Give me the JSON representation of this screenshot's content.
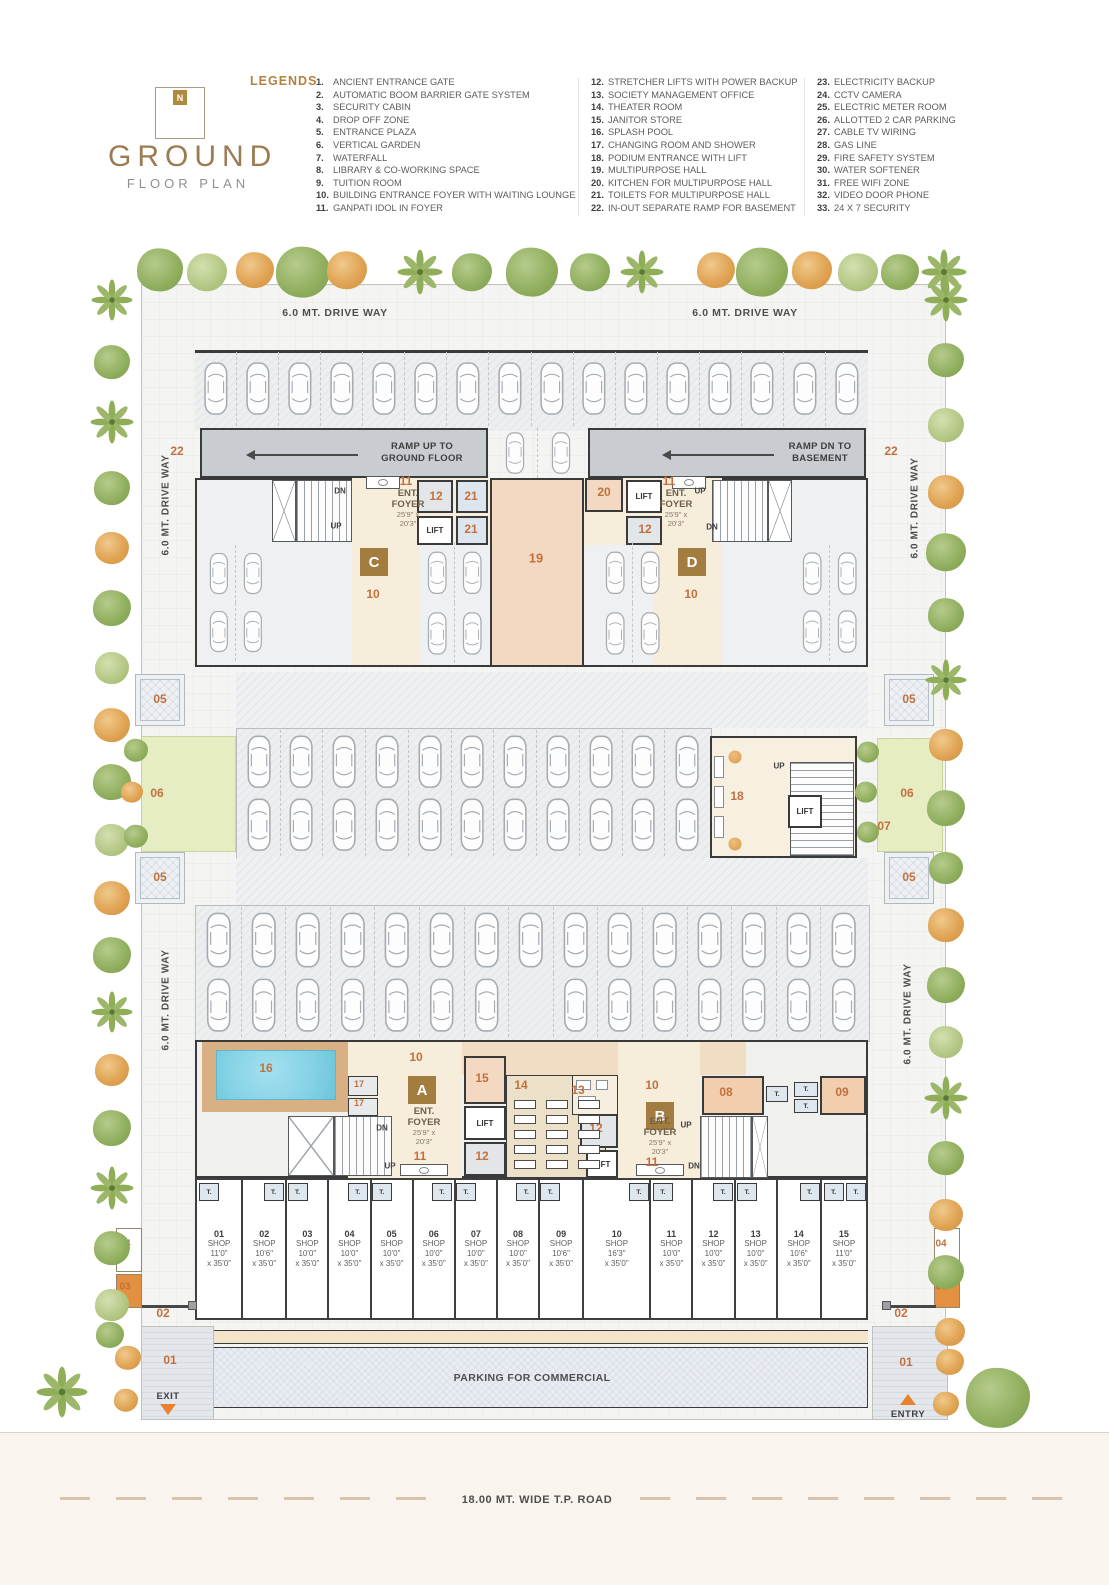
{
  "header": {
    "title": "GROUND",
    "subtitle": "FLOOR PLAN",
    "compass": "N",
    "legends_label": "LEGENDS",
    "legend_columns": [
      {
        "items": [
          {
            "num": "1.",
            "text": "ANCIENT ENTRANCE GATE"
          },
          {
            "num": "2.",
            "text": "AUTOMATIC BOOM BARRIER GATE SYSTEM"
          },
          {
            "num": "3.",
            "text": "SECURITY CABIN"
          },
          {
            "num": "4.",
            "text": "DROP OFF ZONE"
          },
          {
            "num": "5.",
            "text": "ENTRANCE PLAZA"
          },
          {
            "num": "6.",
            "text": "VERTICAL GARDEN"
          },
          {
            "num": "7.",
            "text": "WATERFALL"
          },
          {
            "num": "8.",
            "text": "LIBRARY & CO-WORKING SPACE"
          },
          {
            "num": "9.",
            "text": "TUITION ROOM"
          },
          {
            "num": "10.",
            "text": "BUILDING ENTRANCE FOYER WITH WAITING LOUNGE"
          },
          {
            "num": "11.",
            "text": "GANPATI IDOL IN FOYER"
          }
        ]
      },
      {
        "items": [
          {
            "num": "12.",
            "text": "STRETCHER LIFTS WITH POWER BACKUP"
          },
          {
            "num": "13.",
            "text": "SOCIETY MANAGEMENT OFFICE"
          },
          {
            "num": "14.",
            "text": "THEATER ROOM"
          },
          {
            "num": "15.",
            "text": "JANITOR STORE"
          },
          {
            "num": "16.",
            "text": "SPLASH POOL"
          },
          {
            "num": "17.",
            "text": "CHANGING ROOM AND SHOWER"
          },
          {
            "num": "18.",
            "text": "PODIUM ENTRANCE WITH LIFT"
          },
          {
            "num": "19.",
            "text": "MULTIPURPOSE HALL"
          },
          {
            "num": "20.",
            "text": "KITCHEN FOR MULTIPURPOSE HALL"
          },
          {
            "num": "21.",
            "text": "TOILETS FOR MULTIPURPOSE HALL"
          },
          {
            "num": "22.",
            "text": "IN-OUT SEPARATE RAMP FOR BASEMENT"
          }
        ]
      },
      {
        "items": [
          {
            "num": "23.",
            "text": "ELECTRICITY BACKUP"
          },
          {
            "num": "24.",
            "text": "CCTV CAMERA"
          },
          {
            "num": "25.",
            "text": "ELECTRIC METER ROOM"
          },
          {
            "num": "26.",
            "text": "ALLOTTED 2 CAR PARKING"
          },
          {
            "num": "27.",
            "text": "CABLE TV WIRING"
          },
          {
            "num": "28.",
            "text": "GAS LINE"
          },
          {
            "num": "29.",
            "text": "FIRE SAFETY SYSTEM"
          },
          {
            "num": "30.",
            "text": "WATER SOFTENER"
          },
          {
            "num": "31.",
            "text": "FREE WIFI ZONE"
          },
          {
            "num": "32.",
            "text": "VIDEO DOOR PHONE"
          },
          {
            "num": "33.",
            "text": "24 X 7 SECURITY"
          }
        ]
      }
    ]
  },
  "plan": {
    "labels": {
      "drive_6": "6.0 MT. DRIVE WAY",
      "drive_5": "5.0 MT. DRIVE WAY",
      "ramp_up1": "RAMP UP TO",
      "ramp_up2": "GROUND FLOOR",
      "ramp_dn1": "RAMP DN TO",
      "ramp_dn2": "BASEMENT",
      "ent": "ENT.",
      "foyer": "FOYER",
      "dim1": "25'9\" x",
      "dim2": "20'3\"",
      "lift": "LIFT",
      "up": "UP",
      "dn": "DN",
      "t": "T."
    },
    "blocks": [
      "A",
      "B",
      "C",
      "D"
    ],
    "nums": {
      "01": "01",
      "02": "02",
      "03": "03",
      "04": "04",
      "05": "05",
      "06": "06",
      "07": "07",
      "08": "08",
      "09": "09",
      "10": "10",
      "11": "11",
      "12": "12",
      "13": "13",
      "14": "14",
      "15": "15",
      "16": "16",
      "17": "17",
      "18": "18",
      "19": "19",
      "20": "20",
      "21": "21",
      "22": "22"
    },
    "shops": [
      {
        "num": "01",
        "label": "SHOP",
        "dim1": "11'0\"",
        "dim2": "x 35'0\""
      },
      {
        "num": "02",
        "label": "SHOP",
        "dim1": "10'6\"",
        "dim2": "x 35'0\""
      },
      {
        "num": "03",
        "label": "SHOP",
        "dim1": "10'0\"",
        "dim2": "x 35'0\""
      },
      {
        "num": "04",
        "label": "SHOP",
        "dim1": "10'0\"",
        "dim2": "x 35'0\""
      },
      {
        "num": "05",
        "label": "SHOP",
        "dim1": "10'0\"",
        "dim2": "x 35'0\""
      },
      {
        "num": "06",
        "label": "SHOP",
        "dim1": "10'0\"",
        "dim2": "x 35'0\""
      },
      {
        "num": "07",
        "label": "SHOP",
        "dim1": "10'0\"",
        "dim2": "x 35'0\""
      },
      {
        "num": "08",
        "label": "SHOP",
        "dim1": "10'0\"",
        "dim2": "x 35'0\""
      },
      {
        "num": "09",
        "label": "SHOP",
        "dim1": "10'6\"",
        "dim2": "x 35'0\""
      },
      {
        "num": "10",
        "label": "SHOP",
        "dim1": "16'3\"",
        "dim2": "x 35'0\""
      },
      {
        "num": "11",
        "label": "SHOP",
        "dim1": "10'0\"",
        "dim2": "x 35'0\""
      },
      {
        "num": "12",
        "label": "SHOP",
        "dim1": "10'0\"",
        "dim2": "x 35'0\""
      },
      {
        "num": "13",
        "label": "SHOP",
        "dim1": "10'0\"",
        "dim2": "x 35'0\""
      },
      {
        "num": "14",
        "label": "SHOP",
        "dim1": "10'6\"",
        "dim2": "x 35'0\""
      },
      {
        "num": "15",
        "label": "SHOP",
        "dim1": "11'0\"",
        "dim2": "x 35'0\""
      }
    ],
    "bottom": {
      "parking_commercial": "PARKING FOR COMMERCIAL",
      "road": "18.00 MT. WIDE T.P. ROAD",
      "exit": "EXIT",
      "entry": "ENTRY"
    }
  }
}
